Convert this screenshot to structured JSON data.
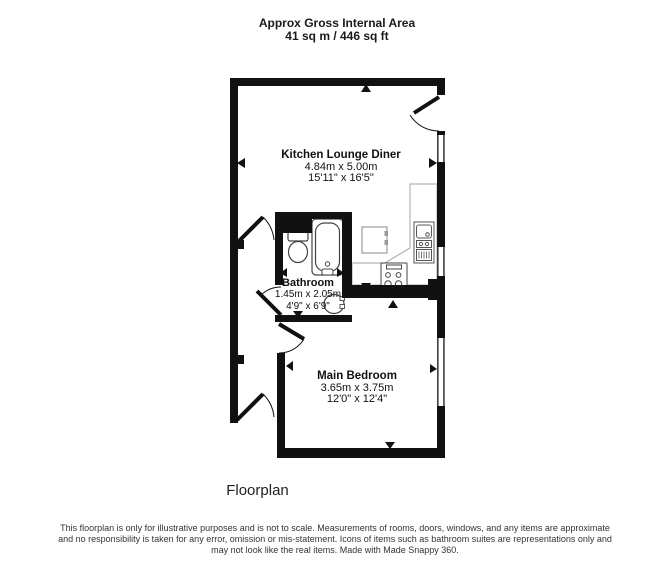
{
  "header": {
    "title_line1": "Approx Gross Internal Area",
    "title_line2": "41 sq m / 446 sq ft"
  },
  "rooms": [
    {
      "name": "Kitchen Lounge Diner",
      "metric": "4.84m x 5.00m",
      "imperial": "15'11\" x 16'5\""
    },
    {
      "name": "Bathroom",
      "metric": "1.45m x 2.05m",
      "imperial": "4'9\" x 6'9\""
    },
    {
      "name": "Main Bedroom",
      "metric": "3.65m x 3.75m",
      "imperial": "12'0\" x 12'4\""
    }
  ],
  "caption": "Floorplan",
  "disclaimer": {
    "line1": "This floorplan is only for illustrative purposes and is not to scale. Measurements of rooms, doors, windows, and any items are approximate",
    "line2": "and no responsibility is taken for any error, omission or mis-statement. Icons of items such as bathroom suites are representations only and",
    "line3": "may not look like the real items. Made with Made Snappy 360."
  },
  "colors": {
    "wall": "#111111",
    "fixture": "#4d4d4d",
    "counter": "#b3b3b3",
    "disclaimer_text": "#333333"
  },
  "icons": {
    "bath": "bath-icon",
    "toilet": "toilet-icon",
    "basin": "basin-icon",
    "hob": "hob-icon",
    "kitchen_sink": "kitchen-sink-icon",
    "washing_machine": "washing-machine-icon",
    "door": "door-swing-icon",
    "window": "window-icon",
    "arrow": "measurement-arrow-icon"
  }
}
